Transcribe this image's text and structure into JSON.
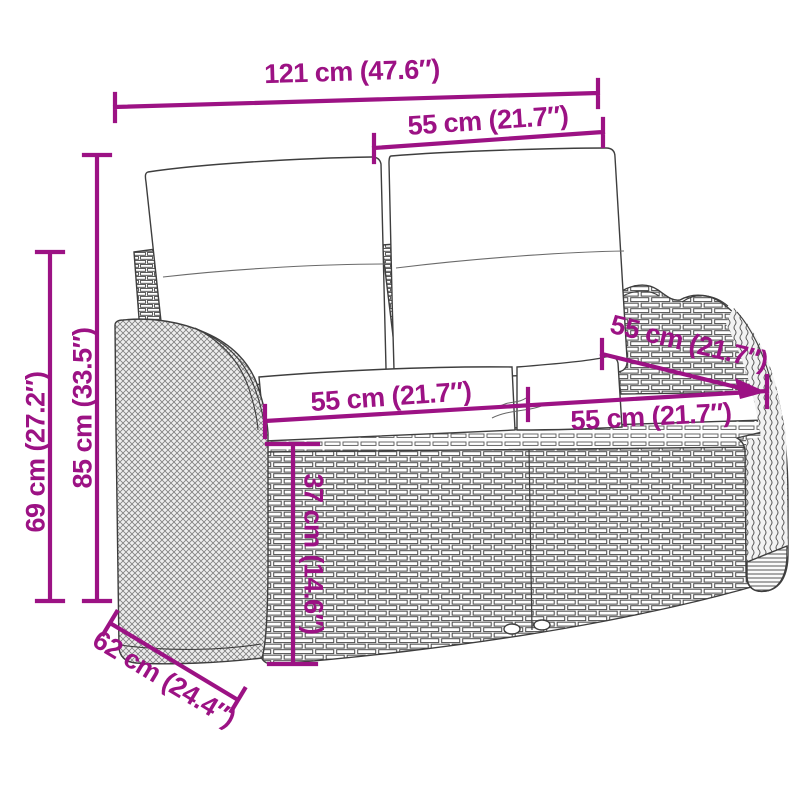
{
  "figure": {
    "kind": "product-dimension-diagram",
    "illustration": "wicker-garden-bench-with-cushions-line-art"
  },
  "dimensions": [
    {
      "id": "total-width",
      "label": "121 cm (47.6″)"
    },
    {
      "id": "backrest-cushion-width",
      "label": "55 cm (21.7″)"
    },
    {
      "id": "total-height",
      "label": "85 cm (33.5″)"
    },
    {
      "id": "armrest-height",
      "label": "69 cm (27.2″)"
    },
    {
      "id": "seat-width-left",
      "label": "55 cm (21.7″)"
    },
    {
      "id": "seat-width-right",
      "label": "55 cm (21.7″)"
    },
    {
      "id": "seat-depth",
      "label": "55 cm (21.7″)"
    },
    {
      "id": "seat-height",
      "label": "37 cm (14.6″)"
    },
    {
      "id": "total-depth",
      "label": "62 cm (24.4″)"
    }
  ],
  "colors": {
    "dimension_accent": "#9C1284",
    "line_art": "#3E3E3E",
    "background": "#FFFFFF",
    "cushion_fill": "#FFFFFF"
  }
}
